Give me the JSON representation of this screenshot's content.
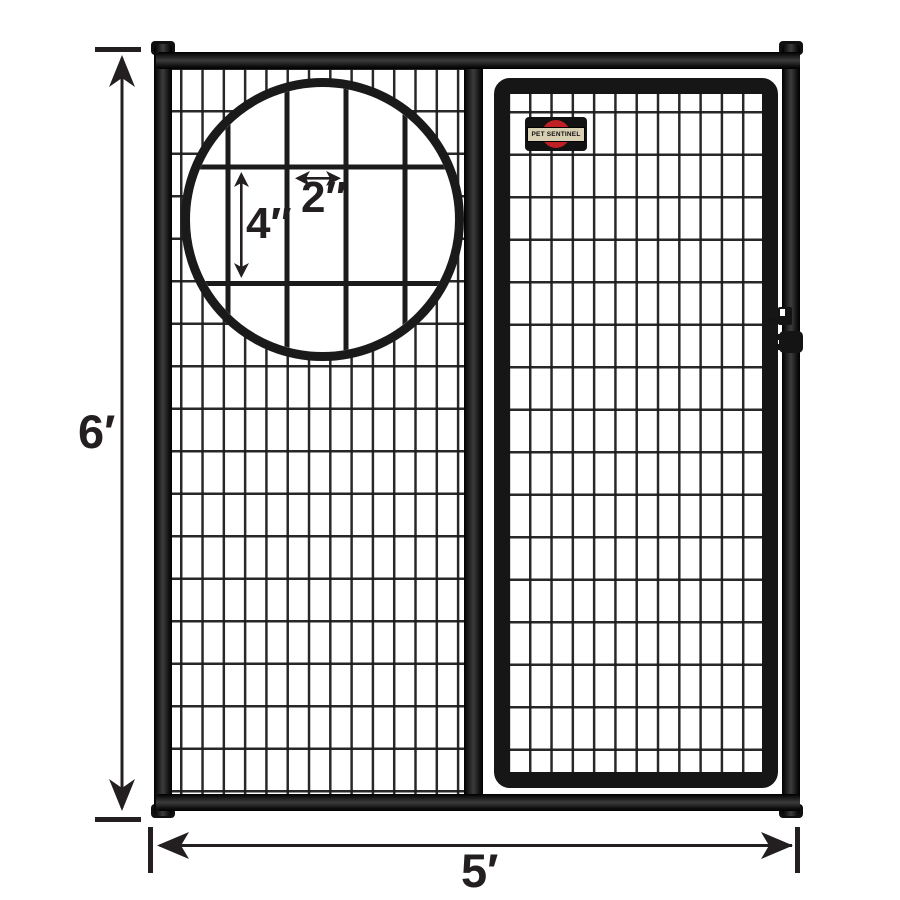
{
  "logo": {
    "text": "PET SENTINEL"
  },
  "dimensions": {
    "panel_height": "6′",
    "panel_width": "5′",
    "mesh_cell_height": "4″",
    "mesh_cell_width": "2″"
  },
  "mesh": {
    "cell_width_label": "2″",
    "cell_height_label": "4″"
  },
  "colors": {
    "background": "#ffffff",
    "frame": "#161616",
    "wire": "#1c1c1c",
    "dimension_text": "#231f20",
    "logo_red": "#bf2026",
    "logo_band": "#d9d0b4"
  }
}
